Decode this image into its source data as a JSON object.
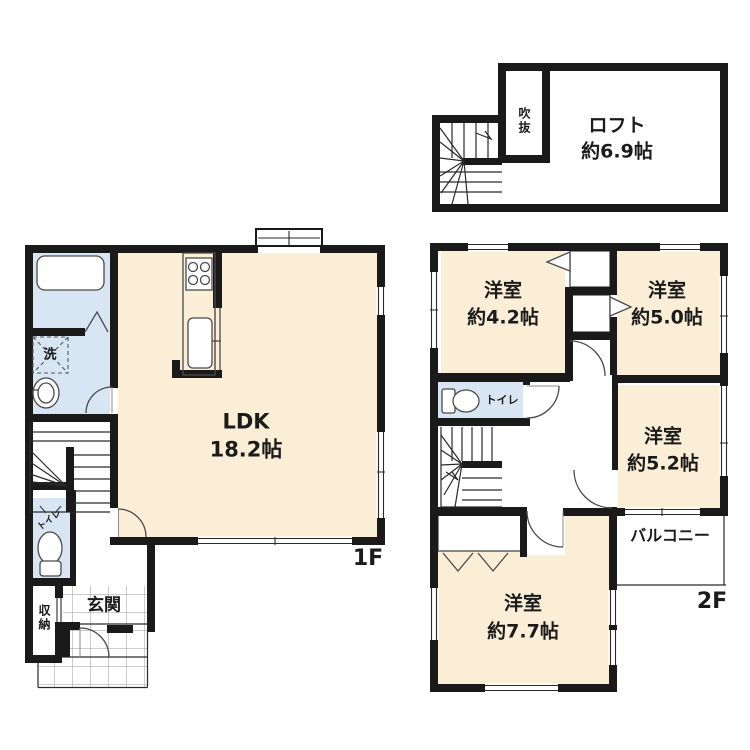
{
  "colors": {
    "wall": "#1a1a1a",
    "room": "#fbeed6",
    "wet": "#d7e6f2",
    "tile": "#9a9a9a"
  },
  "loft": {
    "name": "ロフト",
    "size": "約6.9帖",
    "void_label": "吹抜"
  },
  "floor1": {
    "ldk_name": "LDK",
    "ldk_size": "18.2帖",
    "floor_tag": "1F",
    "wash_label": "洗",
    "toilet_label": "トイレ",
    "entrance_label": "玄関",
    "storage_label": "収納"
  },
  "floor2": {
    "floor_tag": "2F",
    "toilet_label": "トイレ",
    "balcony_label": "バルコニー",
    "rooms": [
      {
        "name": "洋室",
        "size": "約4.2帖"
      },
      {
        "name": "洋室",
        "size": "約5.0帖"
      },
      {
        "name": "洋室",
        "size": "約5.2帖"
      },
      {
        "name": "洋室",
        "size": "約7.7帖"
      }
    ]
  }
}
